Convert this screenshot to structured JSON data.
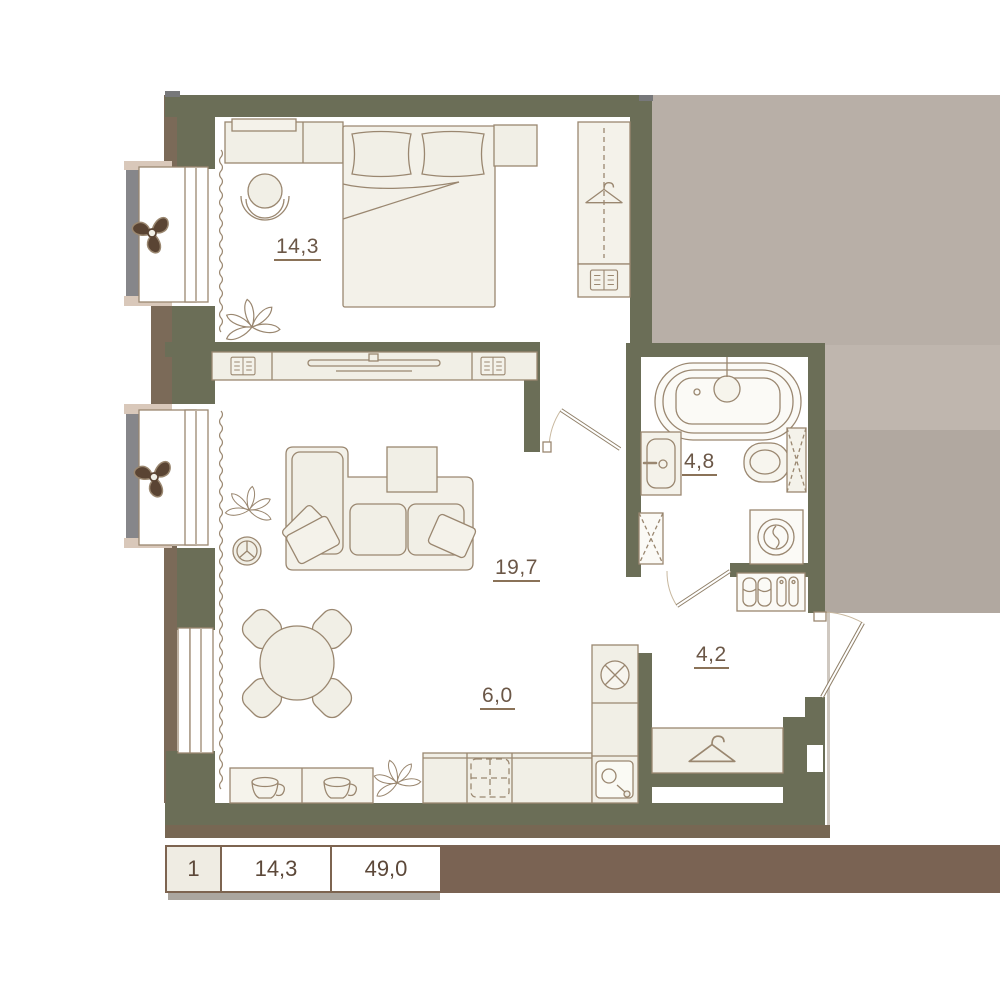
{
  "plan": {
    "title": "apartment-floor-plan",
    "rooms": [
      {
        "id": "bedroom",
        "area": "14,3"
      },
      {
        "id": "living",
        "area": "19,7"
      },
      {
        "id": "bathroom",
        "area": "4,8"
      },
      {
        "id": "hallway",
        "area": "4,2"
      },
      {
        "id": "kitchen",
        "area": "6,0"
      }
    ],
    "legend": {
      "rooms_count": "1",
      "living_area": "14,3",
      "total_area": "49,0"
    },
    "colors": {
      "wall": "#6b6e57",
      "wall_outer_brown": "#7b6a58",
      "bottom_shadow": "#776753",
      "floor": "#ffffff",
      "furniture_fill": "#f1efe6",
      "furniture_stroke": "#9a8770",
      "outside_upper": "#b8afa7",
      "outside_lower": "#b1a8a0",
      "outside_strip": "#bfb6ae",
      "balcony_rail": "#86868a",
      "sill_cap": "#d9c8ba",
      "fan": "#5a4433",
      "legend_bar": "#7a6353",
      "label_text": "#6b5747"
    },
    "icons": [
      "fan-icon",
      "plant-icon",
      "hanger-icon",
      "book-icon",
      "cup-icon",
      "bathtub-icon",
      "sink-icon",
      "toilet-icon",
      "washing-machine-icon",
      "stove-icon",
      "vent-icon",
      "kitchen-sink-icon",
      "slippers-icon",
      "boots-icon",
      "tv-icon",
      "radiator-icon"
    ]
  }
}
